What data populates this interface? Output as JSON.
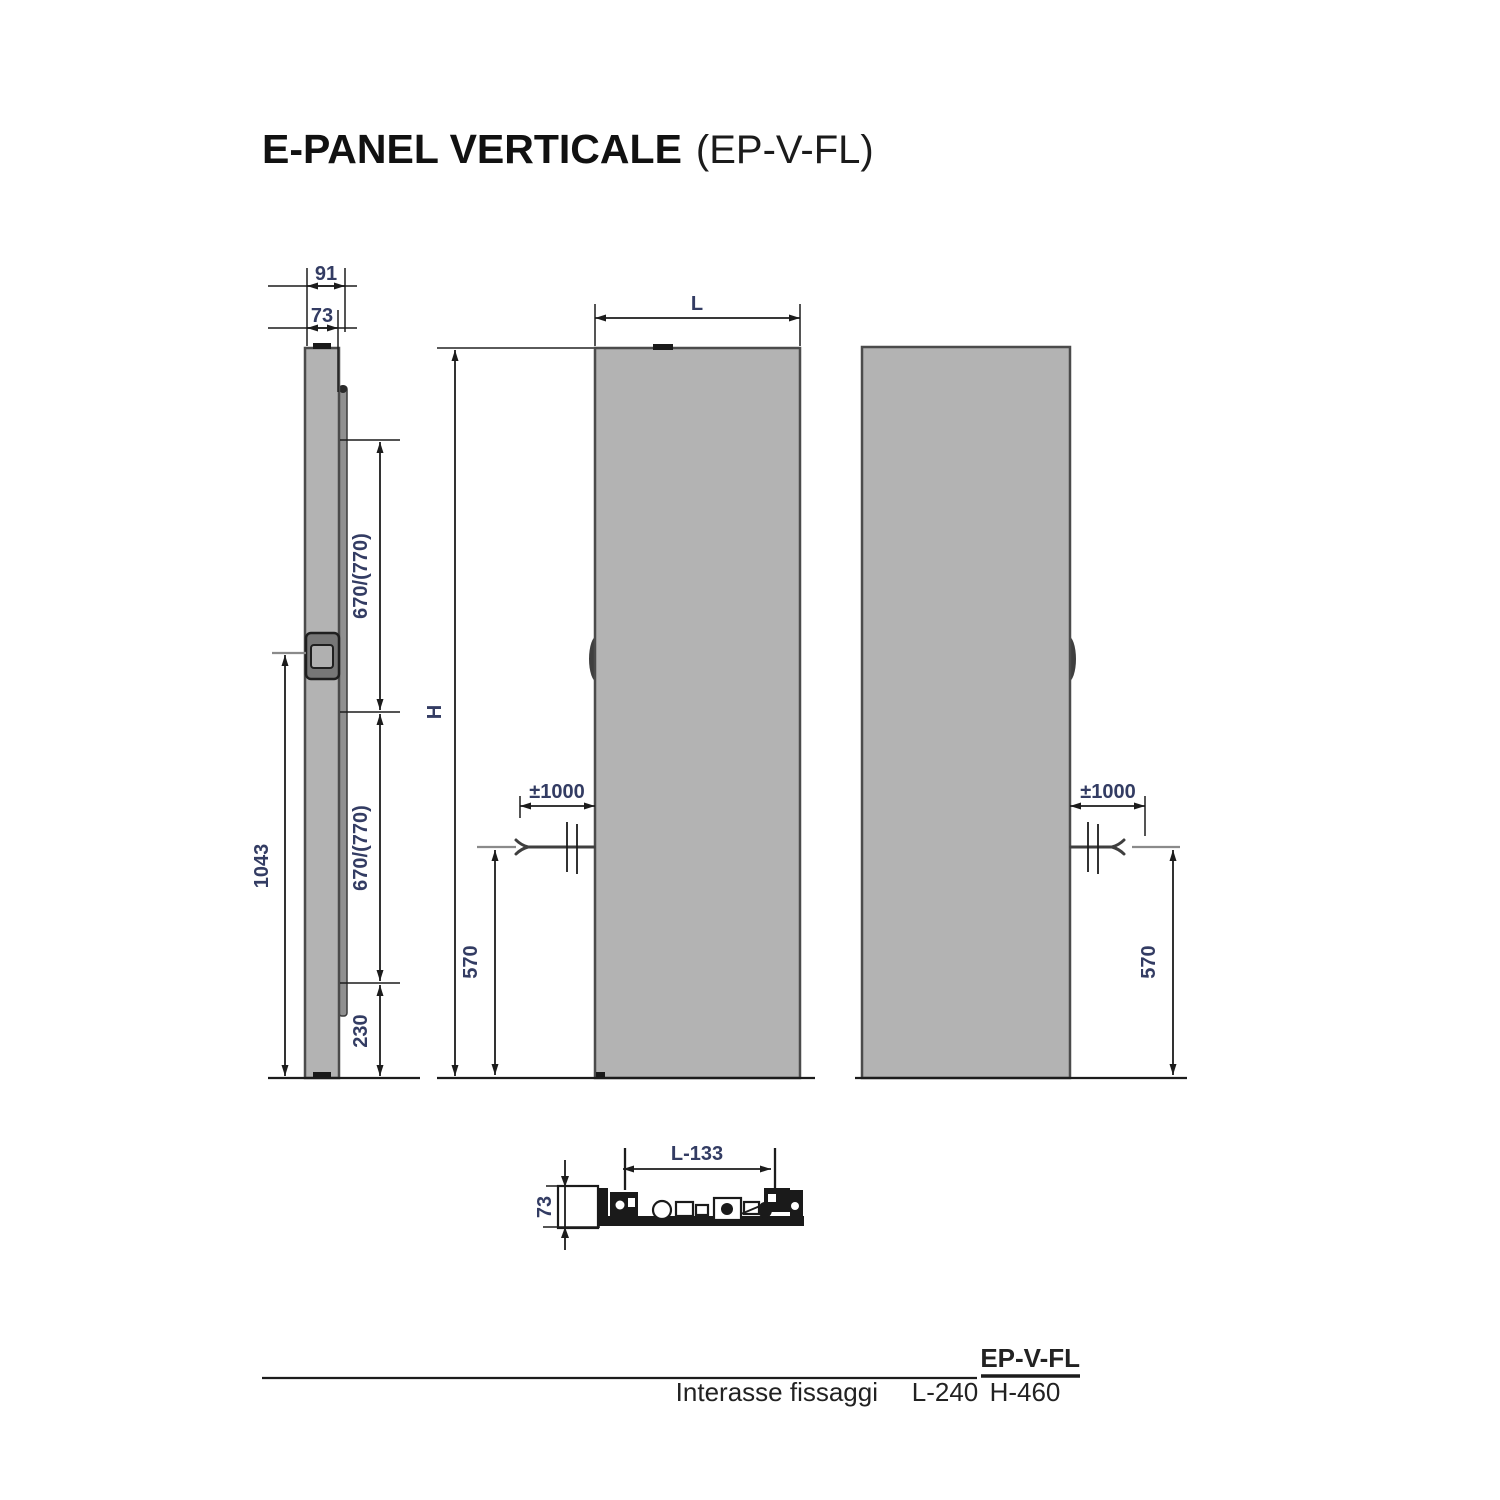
{
  "title": {
    "main": "E-PANEL VERTICALE",
    "code": "(EP-V-FL)"
  },
  "side_view": {
    "depth_total": "91",
    "depth_panel": "73",
    "span_upper": "670/(770)",
    "span_lower": "670/(770)",
    "knob_height": "1043",
    "bottom_clearance": "230"
  },
  "front_view_left": {
    "width_label": "L",
    "height_label": "H",
    "cable_length": "±1000",
    "cable_height": "570"
  },
  "front_view_right": {
    "cable_length": "±1000",
    "cable_height": "570"
  },
  "section_view": {
    "bracket_spacing": "L-133",
    "depth": "73"
  },
  "table": {
    "model": "EP-V-FL",
    "row_label": "Interasse fissaggi",
    "l_value": "L-240",
    "h_value": "H-460"
  },
  "colors": {
    "panel_fill": "#b3b3b3",
    "panel_border": "#4b4b4b",
    "line": "#1c1c1c",
    "dimension_text": "#333c63",
    "text": "#1a1a1a"
  }
}
